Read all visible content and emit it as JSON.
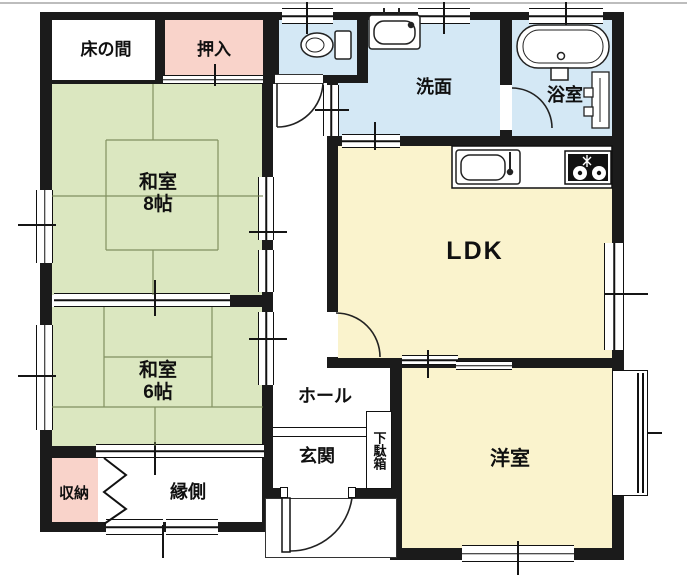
{
  "rooms": {
    "tokonoma": {
      "label": "床の間"
    },
    "oshiire": {
      "label": "押入"
    },
    "washitsu8": {
      "label": "和室",
      "size": "8帖"
    },
    "washitsu6": {
      "label": "和室",
      "size": "6帖"
    },
    "senmen": {
      "label": "洗面"
    },
    "yokushitsu": {
      "label": "浴室"
    },
    "ldk": {
      "label": "LDK"
    },
    "yoshitsu": {
      "label": "洋室"
    },
    "hall": {
      "label": "ホール"
    },
    "genkan": {
      "label": "玄関"
    },
    "getabako": {
      "label": "下駄箱"
    },
    "shuno": {
      "label": "収納"
    },
    "engawa": {
      "label": "縁側"
    }
  },
  "fixtures": [
    "toilet",
    "washbasin",
    "bathtub",
    "shower-panel",
    "kitchen-sink",
    "gas-stove"
  ],
  "colors": {
    "wall": "#1b1b1b",
    "tatami_green": "#dbe7c0",
    "closet_pink": "#f9d3ca",
    "water_blue": "#d4e8f5",
    "living_cream": "#faf3cd"
  }
}
